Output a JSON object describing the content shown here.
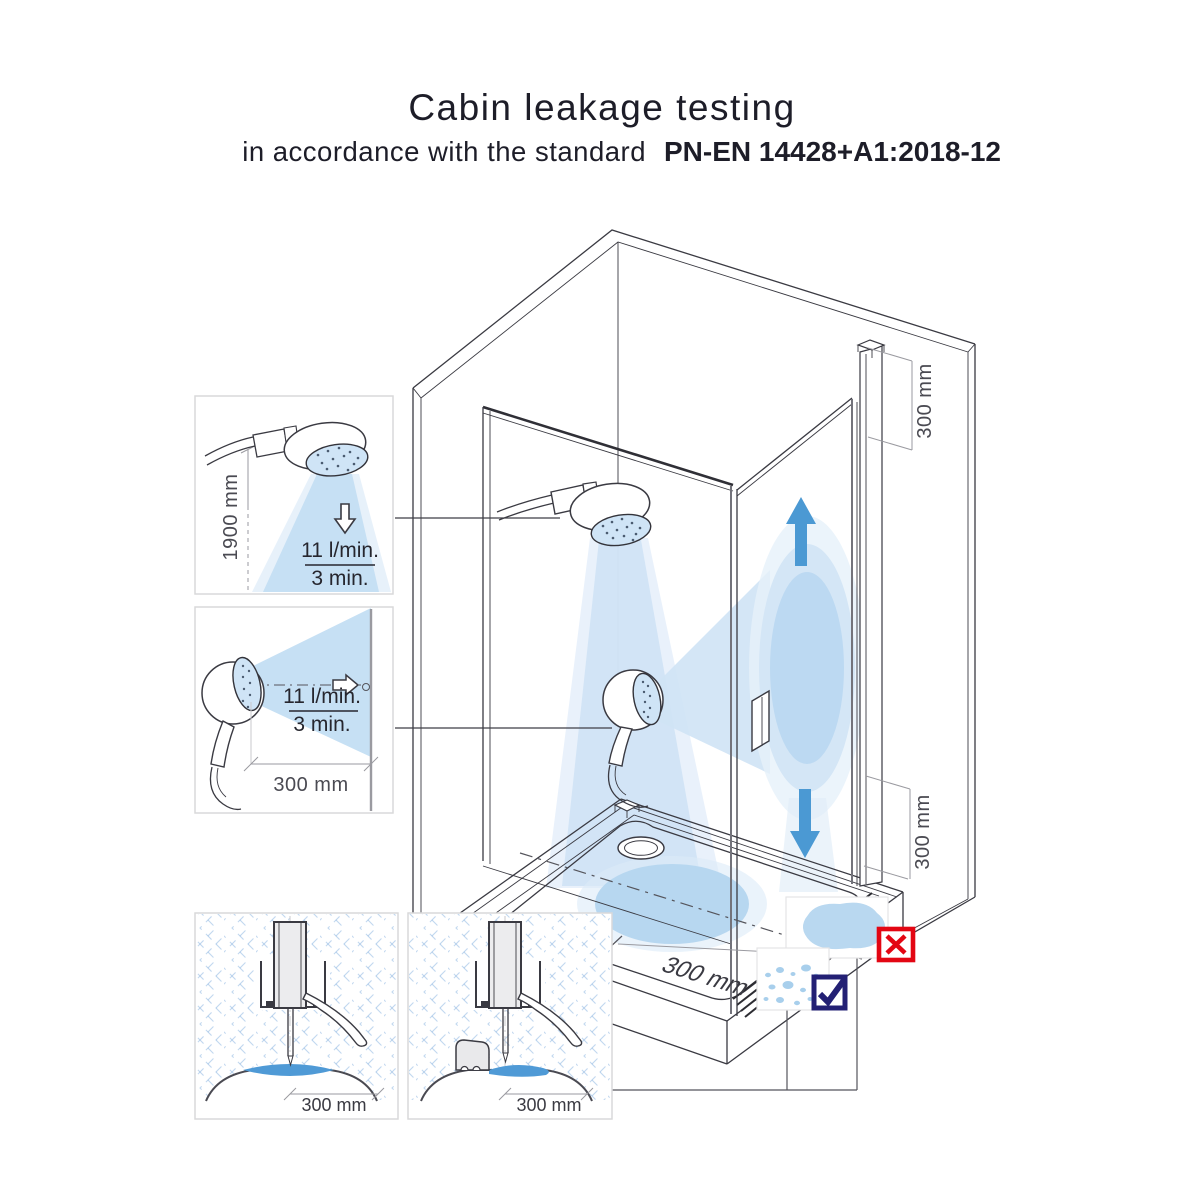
{
  "header": {
    "title": "Cabin leakage testing",
    "subtitle": "in accordance with the standard",
    "standard": "PN-EN 14428+A1:2018-12"
  },
  "insets": {
    "overhead_spray": {
      "height_label": "1900 mm",
      "flow_rate": "11 l/min.",
      "duration": "3 min."
    },
    "horizontal_spray": {
      "distance_label": "300 mm",
      "flow_rate": "11 l/min.",
      "duration": "3 min."
    },
    "seal_no_threshold": {
      "distance_label": "300 mm"
    },
    "seal_with_threshold": {
      "distance_label": "300 mm"
    }
  },
  "cabin": {
    "door_top_offset": "300 mm",
    "door_bottom_offset": "300 mm",
    "tray_distance": "300 mm"
  },
  "result_icons": {
    "fail": {
      "icon": "red-cross-icon",
      "color": "#e30613",
      "meaning": "puddle outside cabin"
    },
    "pass": {
      "icon": "navy-check-icon",
      "color": "#232074",
      "meaning": "only small droplets outside"
    }
  },
  "colors": {
    "spray": "#cfe3f5",
    "spray_strong": "#b9d8f1",
    "water": "#4f9ad6",
    "arrow": "#4b99d3",
    "line": "#3a3a42"
  }
}
